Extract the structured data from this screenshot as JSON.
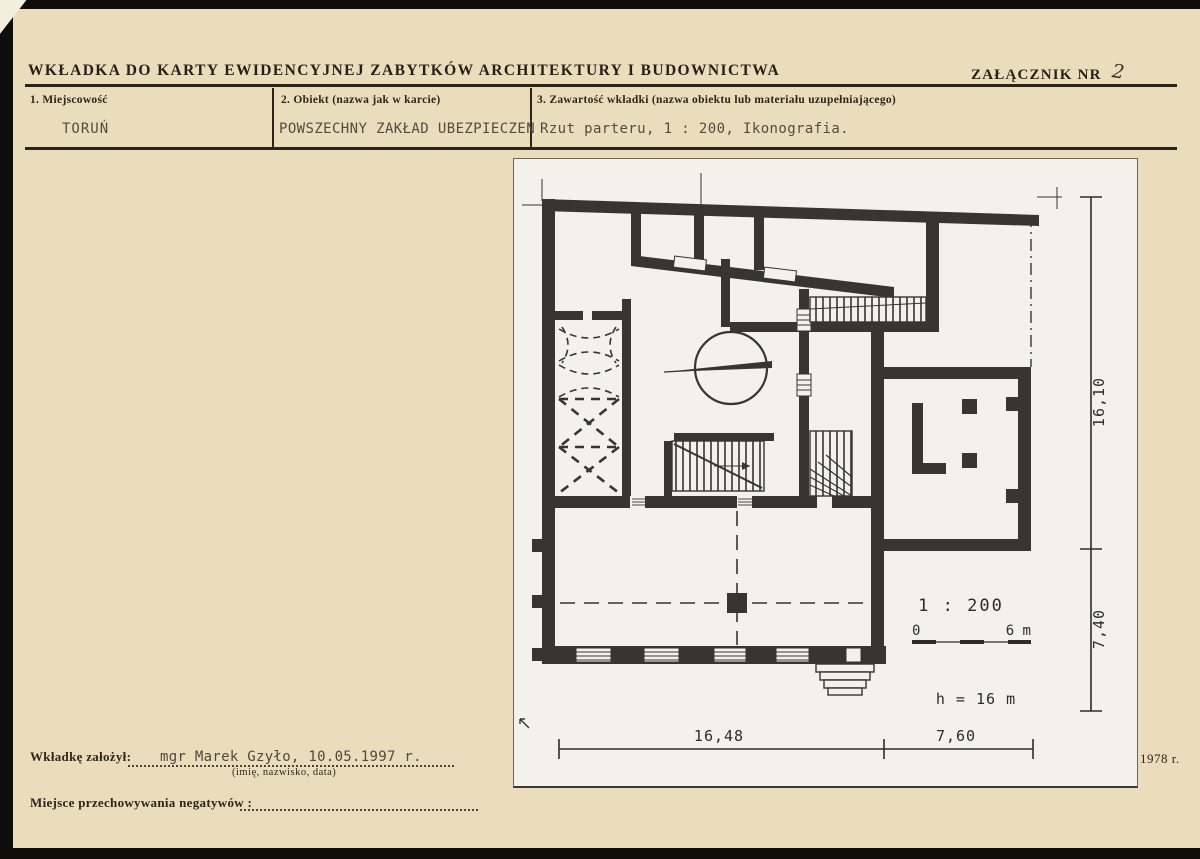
{
  "header": {
    "title": "WKŁADKA DO KARTY EWIDENCYJNEJ ZABYTKÓW ARCHITEKTURY I BUDOWNICTWA",
    "attachment_label": "ZAŁĄCZNIK NR",
    "attachment_number": "2"
  },
  "fields": {
    "f1": {
      "label": "1. Miejscowość",
      "value": "TORUŃ"
    },
    "f2": {
      "label": "2. Obiekt (nazwa jak w karcie)",
      "value": "POWSZECHNY ZAKŁAD UBEZPIECZEŃ"
    },
    "f3": {
      "label": "3. Zawartość wkładki (nazwa obiektu lub materiału uzupełniającego)",
      "value": "Rzut parteru, 1 : 200, Ikonografia."
    }
  },
  "plan": {
    "dim_right_upper": "16,10",
    "dim_right_lower": "7,40",
    "dim_bottom_left": "16,48",
    "dim_bottom_right": "7,60",
    "scale_text": "1 : 200",
    "scale_zero": "0",
    "scale_six": "6 m",
    "height_note": "h = 16 m"
  },
  "footer": {
    "founder_label": "Wkładkę założył:",
    "founder_value": "mgr Marek Gzyło, 10.05.1997 r.",
    "founder_hint": "(imię, nazwisko, data)",
    "negatives_label": "Miejsce przechowywania negatywów :",
    "year_note": "1978 r."
  },
  "colors": {
    "paper": "#e9ddbc",
    "plan_paper": "#f2f1ec",
    "ink": "#2a241d",
    "typewriter_ink": "#514c43",
    "wall": "#383530"
  }
}
